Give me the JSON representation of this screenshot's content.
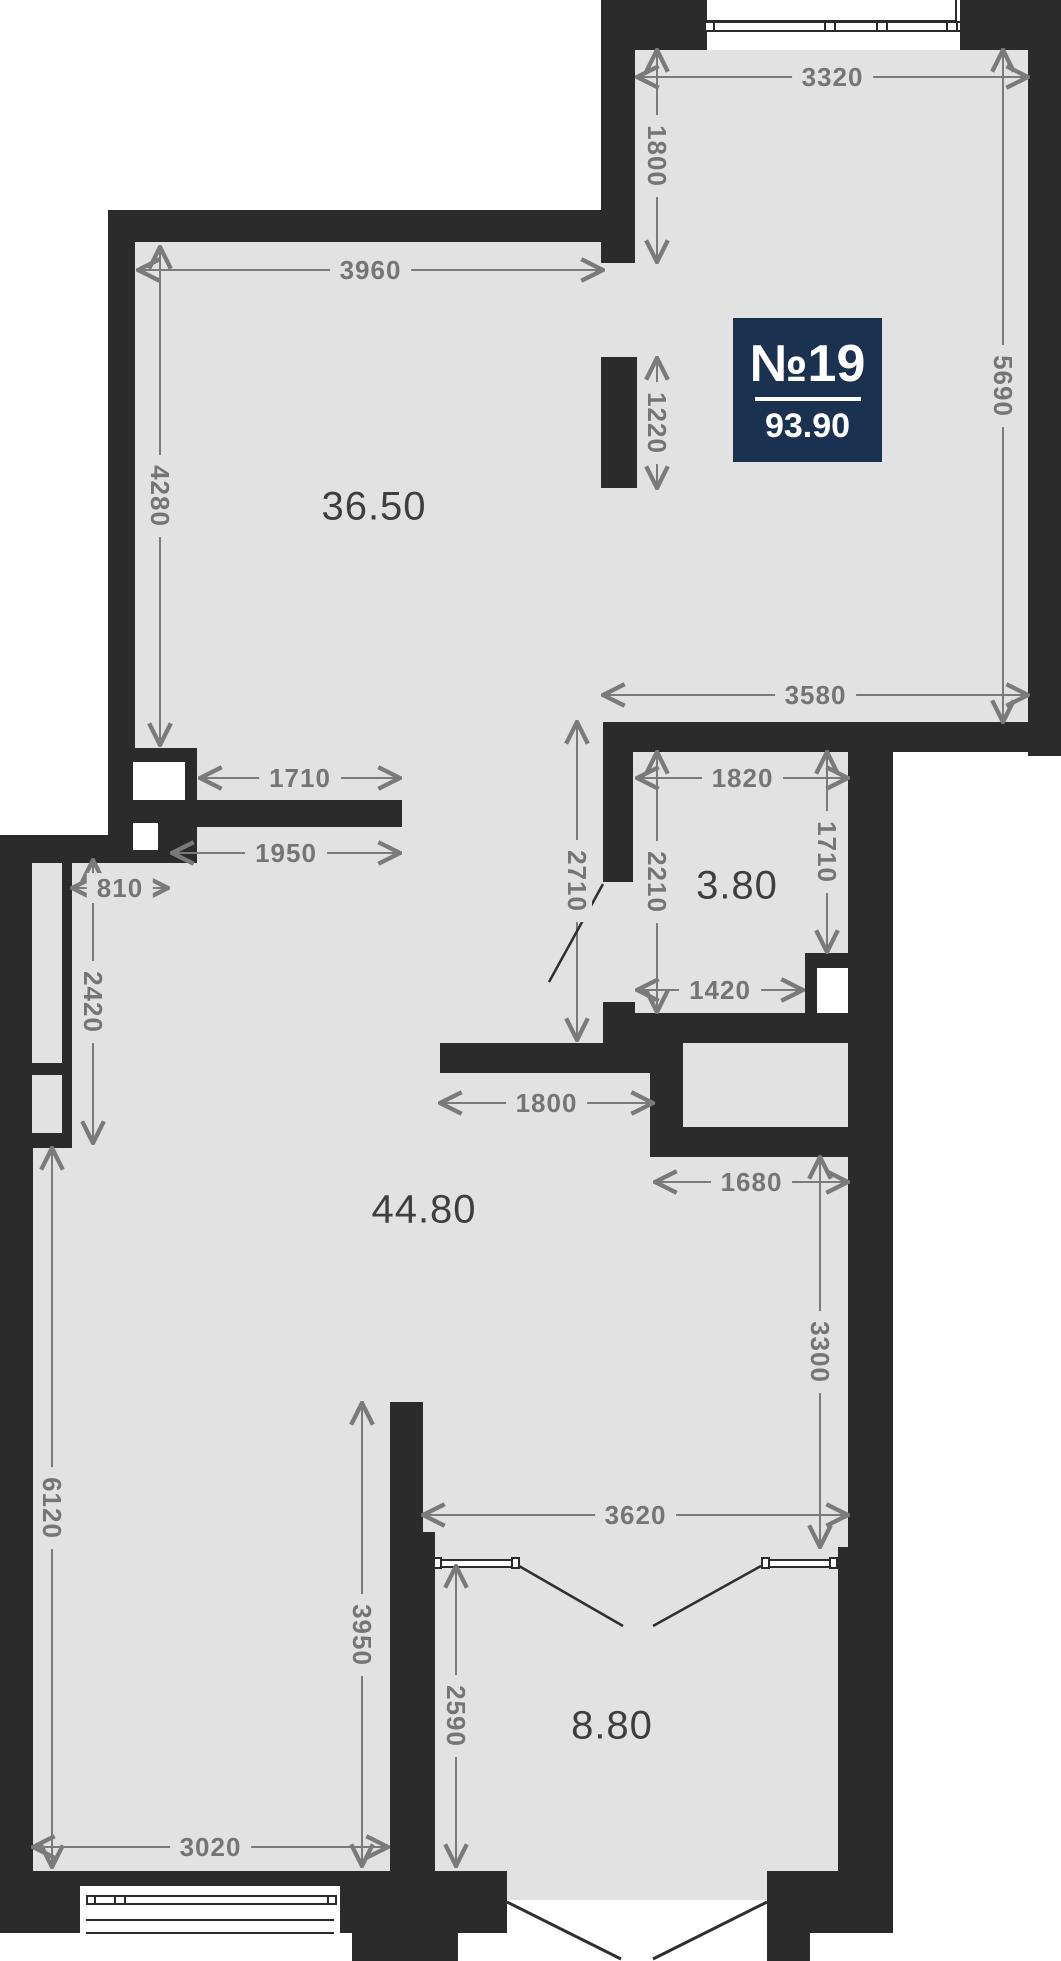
{
  "plan": {
    "unit_badge": {
      "number": "№19",
      "area": "93.90"
    },
    "colors": {
      "wall": "#2b2b2b",
      "floor": "#e2e2e2",
      "outside": "#ffffff",
      "dim": "#7a7a7a",
      "room_label": "#3e3e3e",
      "badge_bg": "#1a3150",
      "badge_text": "#ffffff",
      "door_line": "#2f2f2f"
    },
    "badge_box": [
      733,
      318,
      149,
      144
    ],
    "badge_rule_width": 106,
    "rooms": [
      {
        "t": "36.50",
        "x": 374,
        "y": 507
      },
      {
        "t": "3.80",
        "x": 737,
        "y": 886
      },
      {
        "t": "44.80",
        "x": 424,
        "y": 1210
      },
      {
        "t": "8.80",
        "x": 612,
        "y": 1726
      }
    ],
    "floors": [
      [
        601,
        50,
        427,
        672
      ],
      [
        108,
        210,
        525,
        538
      ],
      [
        108,
        748,
        785,
        115
      ],
      [
        0,
        835,
        893,
        322
      ],
      [
        0,
        1157,
        893,
        755
      ]
    ],
    "walls": [
      [
        601,
        0,
        460,
        50
      ],
      [
        1028,
        0,
        33,
        756
      ],
      [
        603,
        722,
        458,
        30
      ],
      [
        603,
        722,
        30,
        160
      ],
      [
        601,
        0,
        34,
        263
      ],
      [
        601,
        357,
        36,
        131
      ],
      [
        108,
        210,
        527,
        32
      ],
      [
        108,
        210,
        27,
        552
      ],
      [
        108,
        748,
        89,
        115
      ],
      [
        197,
        800,
        205,
        27
      ],
      [
        0,
        835,
        72,
        313
      ],
      [
        72,
        835,
        36,
        28
      ],
      [
        0,
        1148,
        33,
        785
      ],
      [
        0,
        1871,
        80,
        62
      ],
      [
        80,
        1871,
        260,
        15
      ],
      [
        340,
        1871,
        167,
        62
      ],
      [
        352,
        1933,
        106,
        28
      ],
      [
        390,
        1402,
        33,
        130
      ],
      [
        390,
        1532,
        45,
        339
      ],
      [
        440,
        1043,
        210,
        30
      ],
      [
        603,
        1002,
        32,
        41
      ],
      [
        635,
        1013,
        258,
        30
      ],
      [
        650,
        1043,
        33,
        114
      ],
      [
        650,
        1127,
        202,
        30
      ],
      [
        848,
        722,
        45,
        825
      ],
      [
        838,
        1547,
        55,
        386
      ],
      [
        805,
        953,
        47,
        15
      ],
      [
        805,
        968,
        12,
        45
      ],
      [
        767,
        1871,
        126,
        62
      ],
      [
        766,
        1933,
        44,
        28
      ]
    ],
    "white_rects": [
      [
        707,
        0,
        253,
        50
      ],
      [
        133,
        762,
        52,
        38
      ],
      [
        133,
        823,
        25,
        27
      ],
      [
        817,
        968,
        31,
        45
      ],
      [
        80,
        1886,
        260,
        75
      ],
      [
        507,
        1900,
        260,
        61
      ]
    ],
    "gray_rects": [
      [
        32,
        863,
        30,
        200
      ],
      [
        32,
        1075,
        30,
        58
      ]
    ],
    "frames": [
      [
        705,
        -2,
        252,
        24
      ],
      [
        703,
        21,
        259,
        11
      ],
      [
        86,
        1895,
        251,
        10
      ],
      [
        433,
        1559,
        86,
        9
      ],
      [
        761,
        1559,
        77,
        9
      ]
    ],
    "squares": [
      [
        704,
        21,
        11,
        11
      ],
      [
        824,
        21,
        12,
        11
      ],
      [
        876,
        21,
        12,
        11
      ],
      [
        946,
        21,
        12,
        11
      ],
      [
        86,
        1895,
        10,
        10
      ],
      [
        114,
        1895,
        12,
        10
      ],
      [
        327,
        1895,
        10,
        10
      ],
      [
        433,
        1557,
        9,
        12
      ],
      [
        511,
        1557,
        9,
        12
      ],
      [
        761,
        1557,
        9,
        12
      ],
      [
        829,
        1557,
        9,
        12
      ]
    ],
    "thin_lines": [
      [
        86,
        1919,
        248,
        2
      ],
      [
        86,
        1932,
        248,
        2
      ]
    ],
    "dims_h": [
      {
        "t": "3320",
        "x1": 637,
        "x2": 1028,
        "y": 77
      },
      {
        "t": "3960",
        "x1": 138,
        "x2": 603,
        "y": 270
      },
      {
        "t": "3580",
        "x1": 603,
        "x2": 1028,
        "y": 695
      },
      {
        "t": "1820",
        "x1": 637,
        "x2": 848,
        "y": 778
      },
      {
        "t": "1710",
        "x1": 200,
        "x2": 400,
        "y": 778
      },
      {
        "t": "1950",
        "x1": 172,
        "x2": 400,
        "y": 853
      },
      {
        "t": "810",
        "x1": 72,
        "x2": 168,
        "y": 888
      },
      {
        "t": "1420",
        "x1": 637,
        "x2": 803,
        "y": 990
      },
      {
        "t": "1800",
        "x1": 440,
        "x2": 653,
        "y": 1103
      },
      {
        "t": "1680",
        "x1": 655,
        "x2": 848,
        "y": 1182
      },
      {
        "t": "3620",
        "x1": 423,
        "x2": 848,
        "y": 1515
      },
      {
        "t": "3020",
        "x1": 33,
        "x2": 388,
        "y": 1847
      }
    ],
    "dims_v": [
      {
        "t": "1800",
        "y1": 50,
        "y2": 262,
        "x": 657
      },
      {
        "t": "1220",
        "y1": 358,
        "y2": 488,
        "x": 657
      },
      {
        "t": "5690",
        "y1": 50,
        "y2": 722,
        "x": 1003
      },
      {
        "t": "4280",
        "y1": 247,
        "y2": 745,
        "x": 160
      },
      {
        "t": "2710",
        "y1": 722,
        "y2": 1040,
        "x": 577
      },
      {
        "t": "2210",
        "y1": 752,
        "y2": 1012,
        "x": 657
      },
      {
        "t": "1710",
        "y1": 752,
        "y2": 952,
        "x": 827
      },
      {
        "t": "2420",
        "y1": 860,
        "y2": 1143,
        "x": 93
      },
      {
        "t": "3300",
        "y1": 1157,
        "y2": 1547,
        "x": 820
      },
      {
        "t": "6120",
        "y1": 1148,
        "y2": 1867,
        "x": 52
      },
      {
        "t": "3950",
        "y1": 1403,
        "y2": 1866,
        "x": 362
      },
      {
        "t": "2590",
        "y1": 1566,
        "y2": 1866,
        "x": 456
      }
    ],
    "door_lines": [
      [
        519,
        1566,
        623,
        1626
      ],
      [
        761,
        1566,
        653,
        1626
      ],
      [
        603,
        884,
        549,
        982
      ]
    ],
    "entry_lines": [
      [
        507,
        1902,
        621,
        1959
      ],
      [
        767,
        1902,
        653,
        1959
      ]
    ]
  }
}
